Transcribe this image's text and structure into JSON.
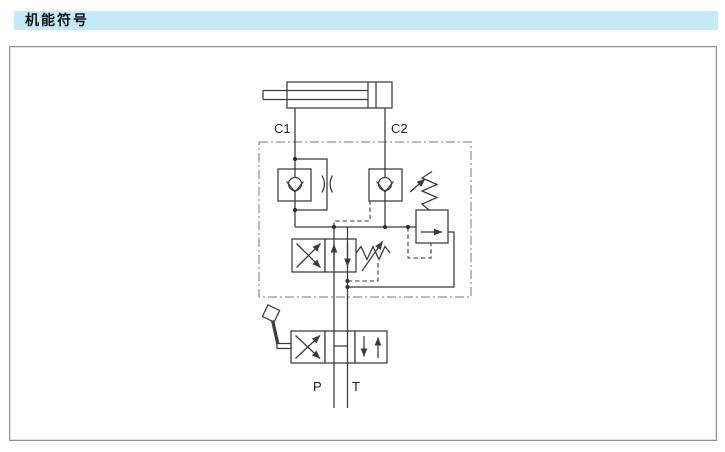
{
  "header": {
    "title": "机能符号"
  },
  "colors": {
    "header_bg": "#c6e9f8",
    "line": "#3a3a3a",
    "panel_border": "#8f8f8f",
    "background": "#ffffff"
  },
  "schematic": {
    "port_labels": {
      "c1": "C1",
      "c2": "C2",
      "p": "P",
      "t": "T"
    },
    "components": [
      {
        "name": "hydraulic-cylinder",
        "type": "single-rod-cylinder"
      },
      {
        "name": "check-valve-with-orifice",
        "type": "check valve with bypass orifice on line C1"
      },
      {
        "name": "check-valve",
        "type": "pilot operated check valve on line C2"
      },
      {
        "name": "relief-valve",
        "type": "adjustable spring relief valve with pilot line"
      },
      {
        "name": "flow-control-valve",
        "type": "2-position valve with adjustable spring and drain"
      },
      {
        "name": "lever-directional-valve",
        "type": "3-position 4-way manual lever valve, open centre P-T"
      }
    ]
  }
}
